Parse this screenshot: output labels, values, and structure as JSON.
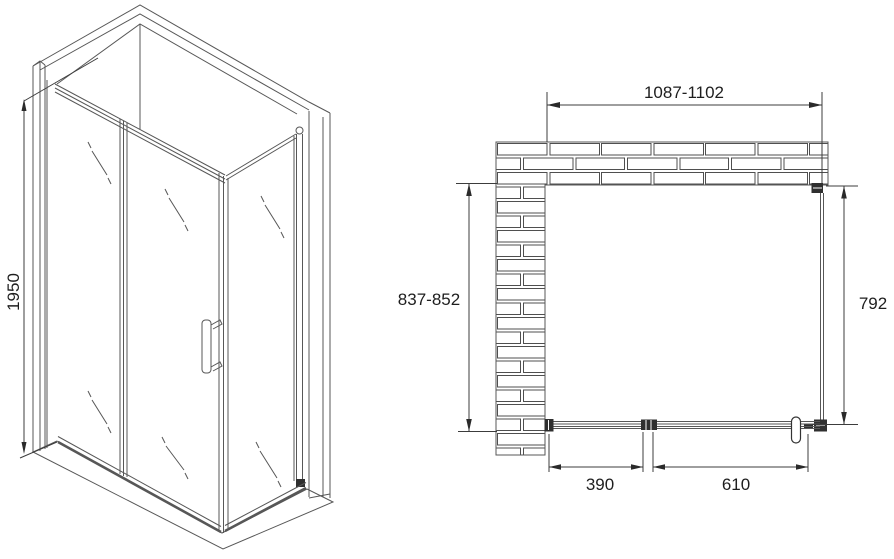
{
  "colors": {
    "background": "#ffffff",
    "line": "#575757",
    "dimension_line": "#3c3c3c",
    "text": "#1e1e1e",
    "hardware": "#2f2f2f"
  },
  "isometric_view": {
    "height_dimension": "1950"
  },
  "plan_view": {
    "width_dimension": "1087-1102",
    "depth_dimension": "837-852",
    "side_panel_dimension": "792",
    "fixed_segment_dimension": "390",
    "door_segment_dimension": "610"
  }
}
